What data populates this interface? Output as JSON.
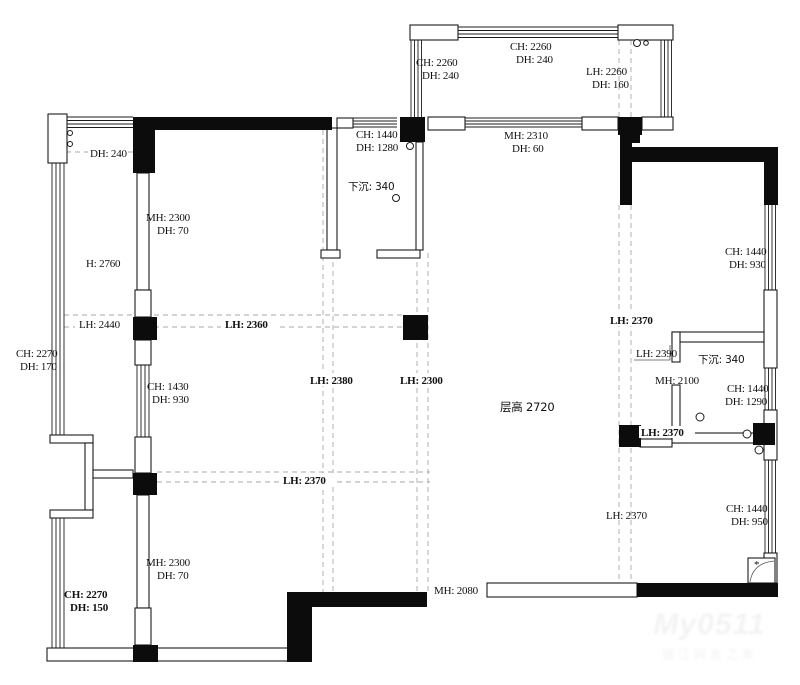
{
  "plan": {
    "type": "apartment-floor-plan",
    "floor_height_label": "层高 2720"
  },
  "labels": {
    "dh240_left": "DH: 240",
    "mh2300_top": "MH: 2300",
    "dh70_top": "DH: 70",
    "h2760": "H: 2760",
    "lh2440": "LH: 2440",
    "ch2270_left": "CH: 2270",
    "dh170_left": "DH: 170",
    "ch1430_mid": "CH: 1430",
    "dh930_mid": "DH: 930",
    "lh2360": "LH: 2360",
    "lh2380": "LH: 2380",
    "lh2300": "LH: 2300",
    "lh2370_mid": "LH: 2370",
    "ch2270_bottom": "CH: 2270",
    "dh150_bottom": "DH: 150",
    "mh2300_bottom": "MH: 2300",
    "dh70_bottom": "DH: 70",
    "mh2080": "MH: 2080",
    "ch2260_balcony_left": "CH: 2260",
    "dh240_balcony_left": "DH: 240",
    "ch2260_balcony_top": "CH: 2260",
    "dh240_balcony_top": "DH: 240",
    "lh2260_balcony": "LH: 2260",
    "dh160_balcony": "DH: 160",
    "mh2310": "MH: 2310",
    "dh60": "DH: 60",
    "ch1440_bath1": "CH: 1440",
    "dh1280_bath1": "DH: 1280",
    "sunken_bath1": "下沉: 340",
    "ch1440_right_upper": "CH: 1440",
    "dh930_right_upper": "DH: 930",
    "lh2370_right_upper": "LH: 2370",
    "lh2390_right": "LH: 2390",
    "sunken_bath2": "下沉: 340",
    "mh2100": "MH: 2100",
    "ch1440_bath2": "CH: 1440",
    "dh1290_bath2": "DH: 1290",
    "lh2370_bath2": "LH: 2370",
    "lh2370_right_lower": "LH: 2370",
    "ch1440_right_lower": "CH: 1440",
    "dh950_right_lower": "DH: 950",
    "floor_height": "层高 2720",
    "corner_star": "*"
  },
  "watermark": {
    "line1": "My0511",
    "line2": "镇江网友之家"
  },
  "colors": {
    "wall_fill": "#0c0c0c",
    "wall_line": "#1c1c1c",
    "dashed_line": "#a8a8a8",
    "background": "#ffffff",
    "text": "#111111"
  }
}
